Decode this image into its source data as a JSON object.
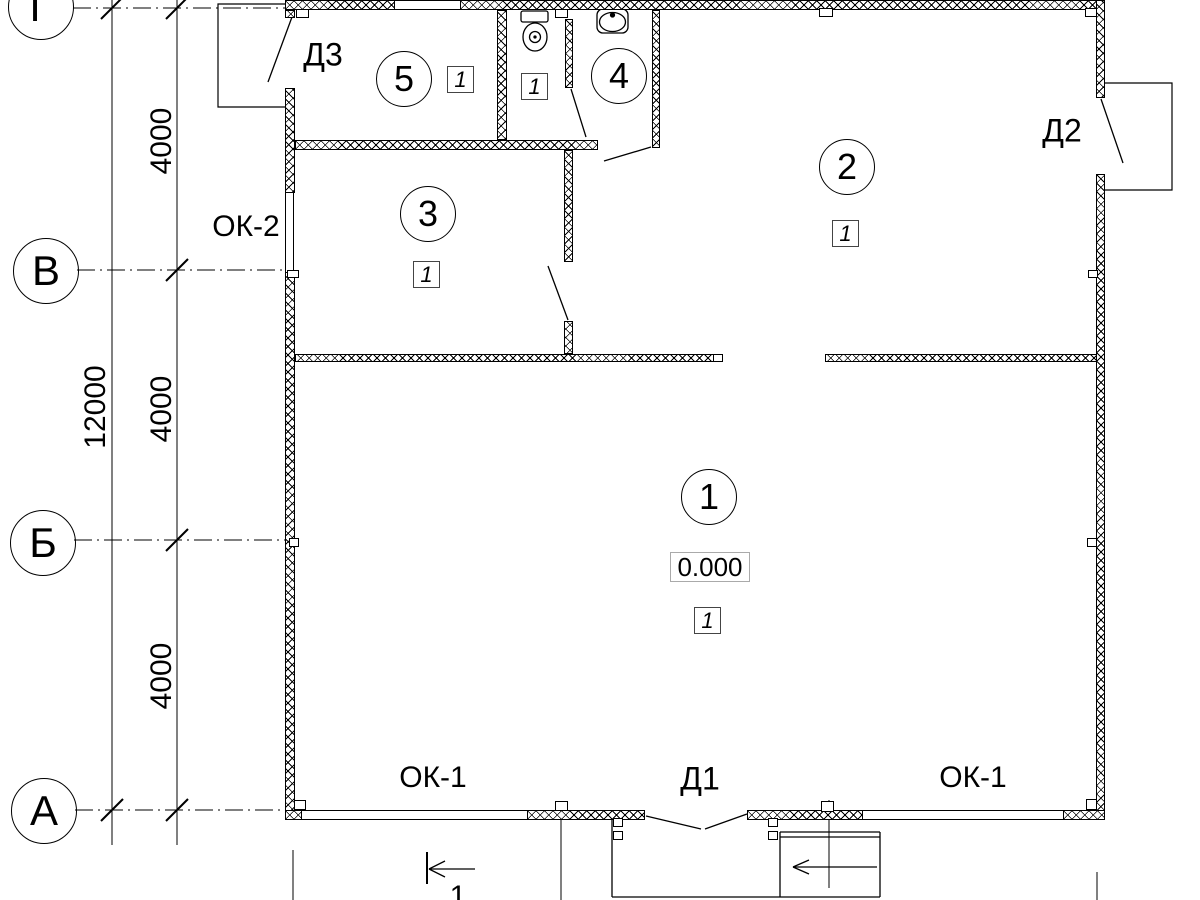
{
  "axes": [
    {
      "label": "Г"
    },
    {
      "label": "В"
    },
    {
      "label": "Б"
    },
    {
      "label": "А"
    }
  ],
  "dimensions": {
    "total": "12000",
    "segments": [
      {
        "value": "4000"
      },
      {
        "value": "4000"
      },
      {
        "value": "4000"
      }
    ]
  },
  "rooms": [
    {
      "number": "1",
      "floor_mark": "1",
      "level": "0.000"
    },
    {
      "number": "2",
      "floor_mark": "1"
    },
    {
      "number": "3",
      "floor_mark": "1"
    },
    {
      "number": "4"
    },
    {
      "number": "5",
      "floor_mark": "1"
    }
  ],
  "wc": {
    "floor_mark": "1"
  },
  "doors": [
    {
      "label": "Д1"
    },
    {
      "label": "Д2"
    },
    {
      "label": "Д3"
    }
  ],
  "windows": [
    {
      "label": "ОК-1"
    },
    {
      "label": "ОК-1"
    },
    {
      "label": "ОК-2"
    }
  ],
  "section": {
    "label": "1"
  }
}
